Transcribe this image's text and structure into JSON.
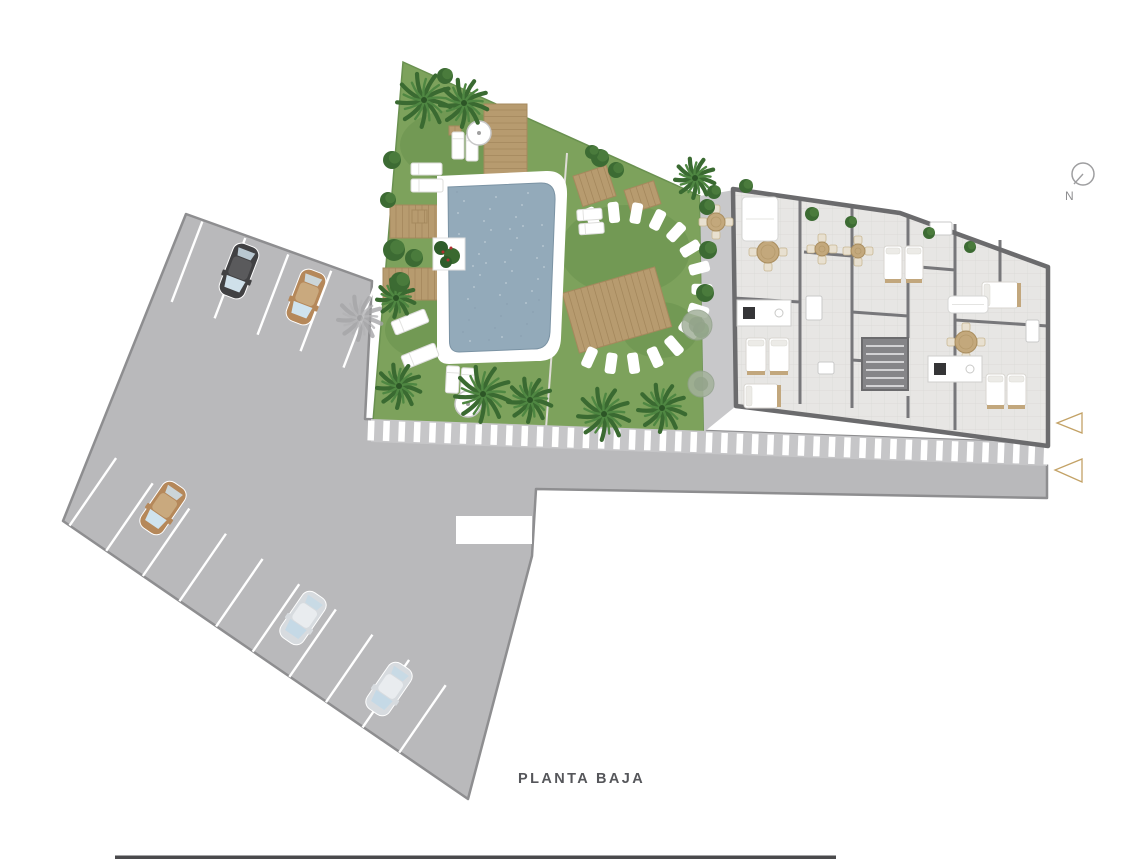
{
  "title": {
    "label": "PLANTA BAJA"
  },
  "compass": {
    "label": "N"
  },
  "colors": {
    "paving": "#b9b9bb",
    "paving_border": "#8e8e90",
    "grass": "#7da25c",
    "grass_dark": "#6f9551",
    "wood": "#b79b6f",
    "wood_line": "#a1855a",
    "pool_water": "#93aaba",
    "pool_deck": "#ffffff",
    "floor": "#e7e6e4",
    "wall": "#6b6b6d",
    "accent_gold": "#c3a266",
    "title_text": "#55565a"
  },
  "plan": {
    "stall_rows": [
      {
        "x": 193,
        "y": 218,
        "dx": 0.934,
        "dy": 0.357,
        "n": 5,
        "step": 46,
        "s0": 10,
        "len": 86,
        "nx": -0.357,
        "ny": 0.934
      },
      {
        "x": 63,
        "y": 521,
        "dx": 0.823,
        "dy": 0.567,
        "n": 10,
        "step": 44.5,
        "s0": 8,
        "len": 82,
        "nx": 0.567,
        "ny": -0.823
      }
    ],
    "cars": [
      {
        "x": 239,
        "y": 271,
        "rot": 21,
        "color": "dark"
      },
      {
        "x": 306,
        "y": 297,
        "rot": 21,
        "color": "tan"
      },
      {
        "x": 163,
        "y": 508,
        "rot": 34.5,
        "color": "tan"
      },
      {
        "x": 303,
        "y": 618,
        "rot": 34.5,
        "color": "silver"
      },
      {
        "x": 389,
        "y": 689,
        "rot": 34.5,
        "color": "silver"
      }
    ],
    "car_colors": {
      "dark": {
        "body": "#414143",
        "roof": "#5a5a5c",
        "glass": "#cfe0ea"
      },
      "tan": {
        "body": "#b5885a",
        "roof": "#c9a97e",
        "glass": "#cfe3ee"
      },
      "silver": {
        "body": "#d7dbdf",
        "roof": "#e9ecef",
        "glass": "#c5d9e6"
      }
    },
    "stripe_band": {
      "x0": 371,
      "y0": 419,
      "x1": 1047,
      "y1": 443,
      "h": 23,
      "n": 45,
      "w": 6.5
    },
    "stepping_stones": {
      "cx": 622,
      "cy": 288,
      "rx": 80,
      "ry": 76,
      "a0": -112,
      "a1": 114,
      "n": 15,
      "sw": 11,
      "sl": 21
    },
    "decks": [
      {
        "x": 484,
        "y": 104,
        "w": 43,
        "h": 79,
        "rot": 0
      },
      {
        "x": 390,
        "y": 205,
        "w": 88,
        "h": 33,
        "rot": 0
      },
      {
        "x": 383,
        "y": 268,
        "w": 94,
        "h": 32,
        "rot": 0
      },
      {
        "x": 569,
        "y": 279,
        "w": 96,
        "h": 62,
        "rot": -16
      },
      {
        "x": 577,
        "y": 170,
        "w": 35,
        "h": 32,
        "rot": -18
      },
      {
        "x": 627,
        "y": 185,
        "w": 31,
        "h": 24,
        "rot": -18
      },
      {
        "x": 412,
        "y": 210,
        "w": 15,
        "h": 13,
        "rot": 0
      },
      {
        "x": 449,
        "y": 126,
        "w": 12,
        "h": 9,
        "rot": 0
      }
    ],
    "loungers": [
      {
        "x": 452,
        "y": 132,
        "w": 12,
        "h": 27,
        "rot": 0
      },
      {
        "x": 466,
        "y": 134,
        "w": 12,
        "h": 27,
        "rot": 0
      },
      {
        "x": 411,
        "y": 163,
        "w": 31,
        "h": 12,
        "rot": 0
      },
      {
        "x": 411,
        "y": 179,
        "w": 32,
        "h": 13,
        "rot": 0
      },
      {
        "x": 392,
        "y": 315,
        "w": 36,
        "h": 14,
        "rot": -22
      },
      {
        "x": 402,
        "y": 349,
        "w": 36,
        "h": 14,
        "rot": -22
      },
      {
        "x": 446,
        "y": 366,
        "w": 13,
        "h": 27,
        "rot": 3
      },
      {
        "x": 461,
        "y": 368,
        "w": 13,
        "h": 27,
        "rot": 3
      },
      {
        "x": 577,
        "y": 209,
        "w": 25,
        "h": 11,
        "rot": -4
      },
      {
        "x": 579,
        "y": 223,
        "w": 25,
        "h": 11,
        "rot": -4
      },
      {
        "x": 1022,
        "y": 400,
        "w": 15,
        "h": 30,
        "rot": 12
      }
    ],
    "umbrellas": [
      {
        "x": 479,
        "y": 133,
        "r": 12
      },
      {
        "x": 468,
        "y": 404,
        "r": 13
      }
    ],
    "palms": [
      {
        "x": 424,
        "y": 100,
        "r": 27
      },
      {
        "x": 464,
        "y": 103,
        "r": 24
      },
      {
        "x": 396,
        "y": 298,
        "r": 19
      },
      {
        "x": 399,
        "y": 386,
        "r": 22
      },
      {
        "x": 483,
        "y": 394,
        "r": 28
      },
      {
        "x": 530,
        "y": 400,
        "r": 22
      },
      {
        "x": 604,
        "y": 414,
        "r": 26
      },
      {
        "x": 662,
        "y": 408,
        "r": 24
      },
      {
        "x": 695,
        "y": 178,
        "r": 20
      },
      {
        "x": 360,
        "y": 318,
        "r": 22,
        "shadow": true
      }
    ],
    "bushes": [
      {
        "x": 392,
        "y": 160,
        "r": 9
      },
      {
        "x": 388,
        "y": 200,
        "r": 8
      },
      {
        "x": 394,
        "y": 250,
        "r": 11
      },
      {
        "x": 400,
        "y": 282,
        "r": 10
      },
      {
        "x": 414,
        "y": 258,
        "r": 9
      },
      {
        "x": 445,
        "y": 76,
        "r": 8
      },
      {
        "x": 600,
        "y": 158,
        "r": 9
      },
      {
        "x": 616,
        "y": 170,
        "r": 8
      },
      {
        "x": 592,
        "y": 152,
        "r": 7
      },
      {
        "x": 707,
        "y": 207,
        "r": 8
      },
      {
        "x": 708,
        "y": 250,
        "r": 9
      },
      {
        "x": 705,
        "y": 293,
        "r": 9
      },
      {
        "x": 701,
        "y": 330,
        "r": 8
      },
      {
        "x": 714,
        "y": 192,
        "r": 7
      },
      {
        "x": 746,
        "y": 186,
        "r": 7
      },
      {
        "x": 812,
        "y": 214,
        "r": 7
      },
      {
        "x": 851,
        "y": 222,
        "r": 6
      },
      {
        "x": 929,
        "y": 233,
        "r": 6
      },
      {
        "x": 970,
        "y": 247,
        "r": 6
      }
    ],
    "trees": [
      {
        "x": 697,
        "y": 325,
        "r": 15
      },
      {
        "x": 701,
        "y": 384,
        "r": 13
      }
    ],
    "beds": [
      {
        "x": 746,
        "y": 338,
        "w": 20,
        "h": 34
      },
      {
        "x": 769,
        "y": 338,
        "w": 20,
        "h": 34
      },
      {
        "x": 744,
        "y": 384,
        "w": 34,
        "h": 24
      },
      {
        "x": 884,
        "y": 246,
        "w": 18,
        "h": 34
      },
      {
        "x": 905,
        "y": 246,
        "w": 18,
        "h": 34
      },
      {
        "x": 982,
        "y": 282,
        "w": 36,
        "h": 26
      },
      {
        "x": 986,
        "y": 374,
        "w": 19,
        "h": 32
      },
      {
        "x": 1007,
        "y": 374,
        "w": 19,
        "h": 32
      }
    ],
    "tables": [
      {
        "x": 716,
        "y": 222,
        "r": 9
      },
      {
        "x": 768,
        "y": 252,
        "r": 11
      },
      {
        "x": 822,
        "y": 249,
        "r": 7
      },
      {
        "x": 858,
        "y": 251,
        "r": 7
      },
      {
        "x": 966,
        "y": 342,
        "r": 11
      }
    ],
    "kitchens": [
      {
        "x": 737,
        "y": 300,
        "w": 54,
        "h": 26
      },
      {
        "x": 928,
        "y": 356,
        "w": 54,
        "h": 26
      }
    ],
    "sofas": [
      {
        "x": 742,
        "y": 197,
        "w": 36,
        "h": 44
      },
      {
        "x": 948,
        "y": 296,
        "w": 40,
        "h": 17
      }
    ],
    "fixtures": [
      {
        "x": 806,
        "y": 296,
        "w": 16,
        "h": 24
      },
      {
        "x": 930,
        "y": 222,
        "w": 22,
        "h": 13
      },
      {
        "x": 1026,
        "y": 320,
        "w": 13,
        "h": 22
      },
      {
        "x": 818,
        "y": 362,
        "w": 16,
        "h": 12
      }
    ],
    "entrance_arrows": [
      {
        "points": "1082,413 1082,433 1057,423"
      },
      {
        "points": "1082,459 1082,482 1055,470"
      }
    ]
  }
}
